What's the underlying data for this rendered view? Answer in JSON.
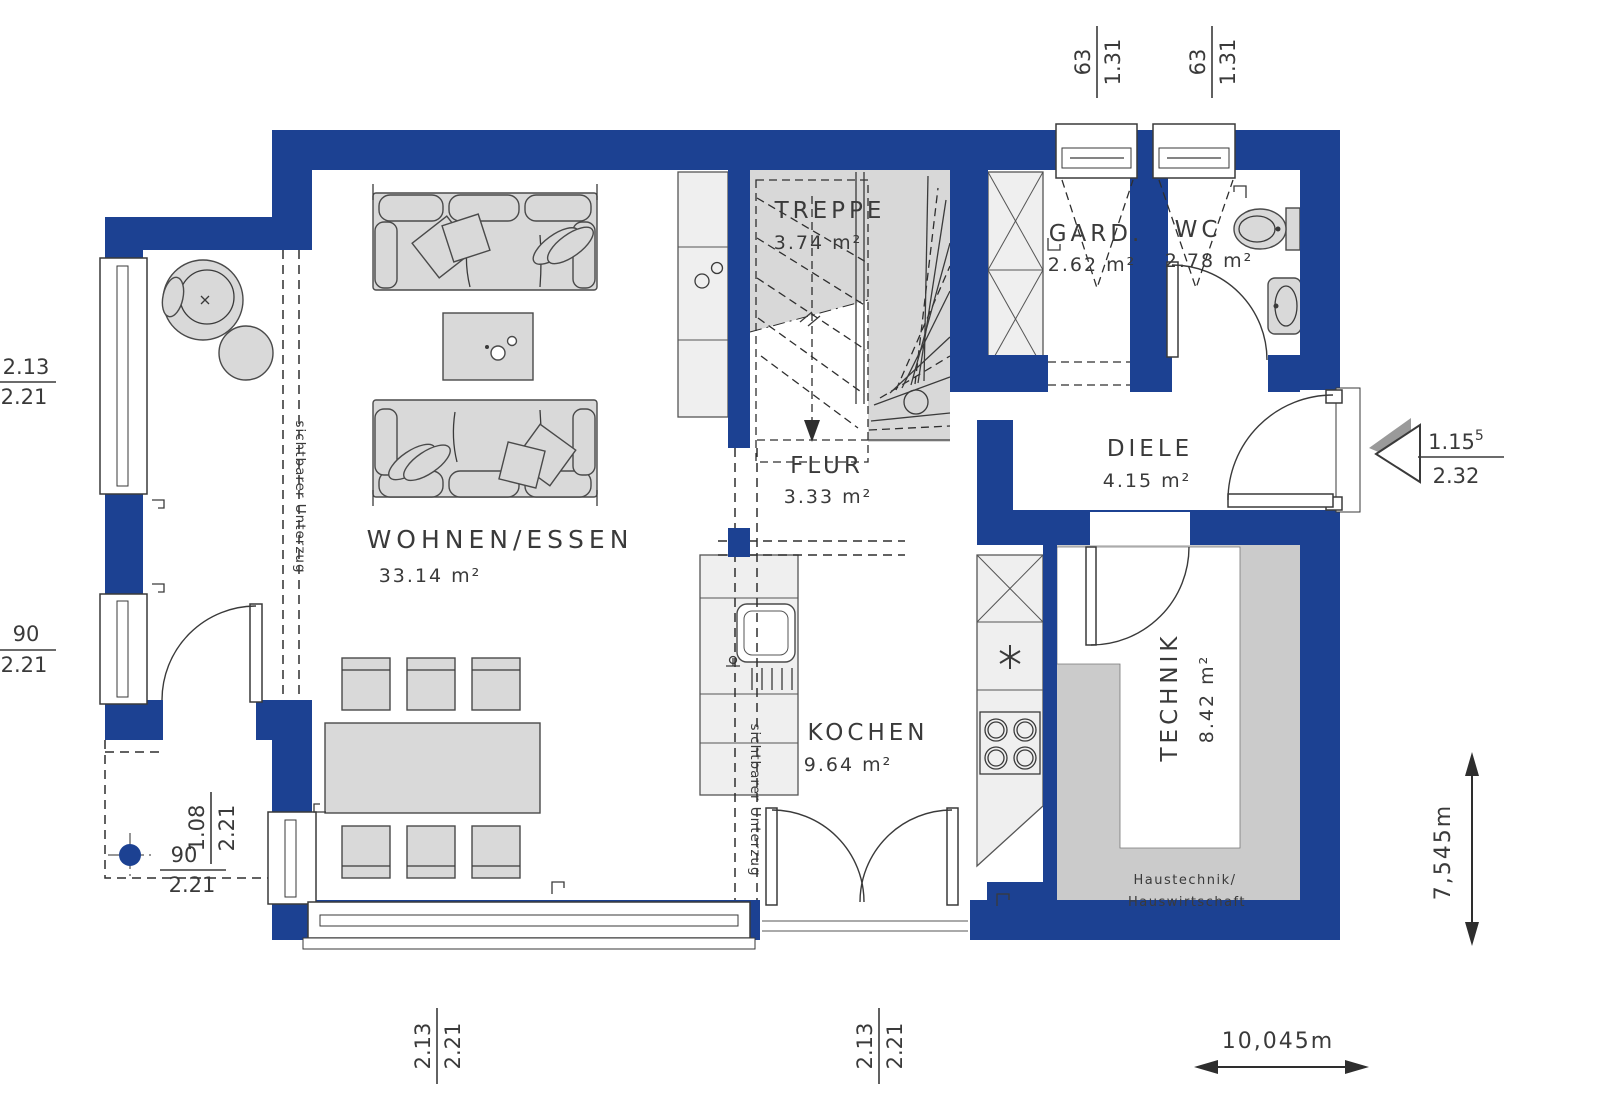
{
  "title": "Erdgeschoss Grundriss",
  "colors": {
    "wall": "#1c4192",
    "stair_gray": "#d8d8d8",
    "technik_gray": "#cbcbcb",
    "furn": "#d9d9d9",
    "counter": "#efefef",
    "line": "#3a3a3a"
  },
  "rooms": [
    {
      "name": "WOHNEN/ESSEN",
      "area": "33.14 m²"
    },
    {
      "name": "TREPPE",
      "area": "3.74 m²"
    },
    {
      "name": "GARD.",
      "area": "2.62 m²"
    },
    {
      "name": "WC",
      "area": "2.78 m²"
    },
    {
      "name": "FLUR",
      "area": "3.33 m²"
    },
    {
      "name": "DIELE",
      "area": "4.15 m²"
    },
    {
      "name": "KOCHEN",
      "area": "9.64 m²"
    },
    {
      "name": "TECHNIK",
      "area": "8.42 m²"
    }
  ],
  "annotations": {
    "beam_living": "sichtbarer Unterzug",
    "beam_kitchen": "sichtbarer Unterzug",
    "technik_note1": "Haustechnik/",
    "technik_note2": "Hauswirtschaft"
  },
  "dimensions": {
    "top_window_1": {
      "num": "63",
      "den": "1.31"
    },
    "top_window_2": {
      "num": "63",
      "den": "1.31"
    },
    "left_upper": {
      "num": "2.13",
      "den": "2.21"
    },
    "left_lower": {
      "num": "90",
      "den": "2.21"
    },
    "bottom_left_rotated": {
      "num": "1.08",
      "den": "2.21"
    },
    "bottom_left_horizontal": {
      "num": "90",
      "den": "2.21"
    },
    "bottom_window": {
      "num": "2.13",
      "den": "2.21"
    },
    "bottom_door": {
      "num": "2.13",
      "den": "2.21"
    },
    "entrance": {
      "num": "1.15",
      "num_sup": "5",
      "den": "2.32"
    },
    "total_height": "7,545m",
    "total_width": "10,045m"
  }
}
